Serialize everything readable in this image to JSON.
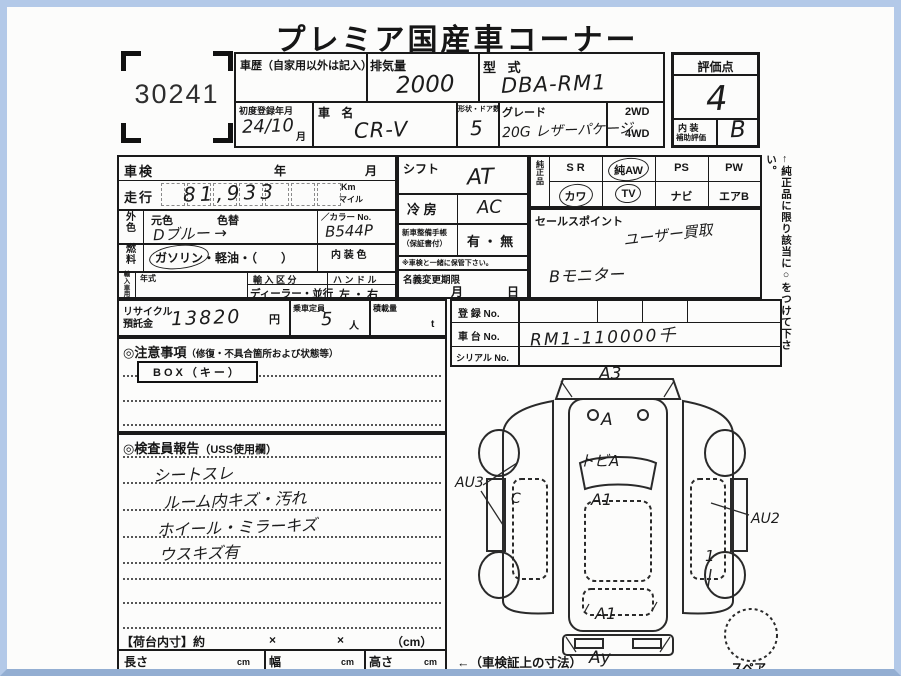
{
  "header": {
    "title": "プレミア国産車コーナー",
    "lot_number": "30241"
  },
  "vehicle": {
    "history_label": "車歴（自家用以外は記入）",
    "displacement_label": "排気量",
    "displacement_value": "2000",
    "model_code_label": "型 式",
    "model_code_value": "DBA-RM1",
    "first_reg_label": "初度登録年月",
    "first_reg_value": "24/10",
    "first_reg_month": "月",
    "name_label": "車 名",
    "name_value": "CR-V",
    "shape_doors_label": "形状・ドア数",
    "shape_doors_value": "5",
    "grade_label": "グレード",
    "grade_value": "20G レザーパケージ",
    "drive_2wd": "2WD",
    "drive_4wd": "4WD"
  },
  "score": {
    "label": "評価点",
    "value": "4",
    "interior_line1": "内 装",
    "interior_line2": "補助評価",
    "interior_value": "B"
  },
  "inspection": {
    "shaken_label": "車検",
    "year": "年",
    "month": "月",
    "mileage_label": "走行",
    "mileage_value": "81,933",
    "unit_km": "Km",
    "unit_mile": "マイル",
    "ext_color_label": "外色",
    "orig_color": "元色",
    "repaint": "色替",
    "color_value": "Dブルー →",
    "color_no_label": "／カラー No.",
    "color_no_value": "B544P",
    "fuel_label": "燃料",
    "fuel_gasoline": "ガソリン",
    "fuel_rest": "・軽油・（　　）",
    "interior_color_label": "内 装 色",
    "import_label": "輸入車用",
    "year_model": "年式",
    "import_class": "輸 入 区 分",
    "import_class_value": "ディーラー・並行",
    "handle": "ハ ン ド ル",
    "handle_value": "左 ・ 右"
  },
  "equipment_box": {
    "shift_label": "シフト",
    "shift_value": "AT",
    "ac_label": "冷 房",
    "ac_value": "AC",
    "manual_line1": "新車整備手帳",
    "manual_line2": "（保証書付）",
    "manual_value": "有 ・ 無",
    "manual_note": "※車検と一緒に保管下さい。",
    "transfer_label": "名義変更期限",
    "transfer_month": "月",
    "transfer_day": "日"
  },
  "oem": {
    "label": "純正品",
    "row1": [
      "S R",
      "純AW",
      "PS",
      "PW"
    ],
    "row2": [
      "カワ",
      "TV",
      "ナビ",
      "エアB"
    ],
    "circled": [
      "純AW",
      "カワ",
      "TV"
    ]
  },
  "sales_point": {
    "label": "セールスポイント",
    "note1": "ユーザー買取",
    "note2": "Bモニター"
  },
  "side_note": "←純正品に限り該当に○をつけて下さい。",
  "recycle": {
    "label1": "リサイクル",
    "label2": "預託金",
    "value": "13820",
    "unit": "円",
    "capacity_label": "乗車定員",
    "capacity_value": "5",
    "capacity_unit": "人",
    "load_label": "積載量",
    "load_unit": "t"
  },
  "registration": {
    "reg_label": "登 録 No.",
    "chassis_label": "車 台 No.",
    "chassis_value": "RM1-110000千",
    "serial_label": "シリアル No."
  },
  "cautions": {
    "header": "◎注意事項",
    "header_sub": "（修復・不具合箇所および状態等）",
    "key_box": "BOX（キー）"
  },
  "inspector_report": {
    "header": "◎検査員報告",
    "header_sub": "（USS使用欄）",
    "lines": [
      "シートスレ",
      "ルーム内キズ・汚れ",
      "ホイール・ミラーキズ",
      "ウスキズ有"
    ]
  },
  "cargo": {
    "label": "【荷台内寸】約",
    "times1": "×",
    "times2": "×",
    "unit": "（cm）",
    "length_label": "長さ",
    "length_unit": "cm",
    "width_label": "幅",
    "width_unit": "cm",
    "height_label": "高さ",
    "height_unit": "cm",
    "dims_note": "←（車検証上の寸法）"
  },
  "bottom_strip": "希 望 出 品 コ ー ナ ー",
  "diagram": {
    "spare_label": "スペア",
    "marks": {
      "top": "A3",
      "hood": "A",
      "windshield": "トビA",
      "roof": "A1",
      "left": "AU3",
      "left_door": "C",
      "right": "AU2",
      "right_panel": "1",
      "rear": "A1",
      "bottom": "Ay"
    }
  }
}
